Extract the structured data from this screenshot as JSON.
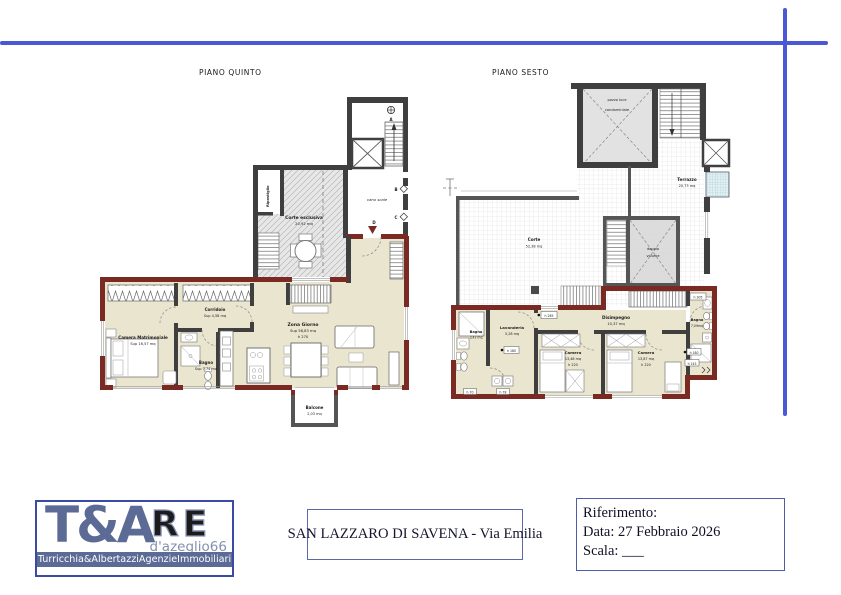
{
  "accent": {
    "line_blue": "#4a58d5",
    "wall_red": "#7a2923",
    "logo_blue": "#5c6a96"
  },
  "plan_quinto": {
    "title": "PIANO QUINTO",
    "vano_scale": "vano scale",
    "ripostiglio": "Ripostiglio",
    "corte_name": "Corte esclusiva",
    "corte_area": "20,92 mq",
    "camera_name": "Camera Matrimoniale",
    "camera_area": "Sup 16,57 mq",
    "corridoio_name": "Corridoio",
    "corridoio_area": "Sup 4,58 mq",
    "bagno_name": "Bagno",
    "bagno_area": "Sup 7,74 mq",
    "zona_name": "Zona Giorno",
    "zona_area": "Sup 58,83 mq",
    "zona_h": "h 270",
    "balcone_name": "Balcone",
    "balcone_area": "2,03 mq",
    "marker_a": "A",
    "marker_b": "B",
    "marker_c": "C",
    "marker_d": "D"
  },
  "plan_sesto": {
    "title": "PIANO SESTO",
    "pozzo_1": "pozzo luce",
    "pozzo_2": "condominiale",
    "terrazzo_name": "Terrazzo",
    "terrazzo_area": "20,73 mq",
    "corte_name": "Corte",
    "corte_area": "52,38 mq",
    "doppio_1": "doppio",
    "doppio_2": "volume",
    "bagno_sx_name": "Bagno",
    "bagno_sx_area": "3,42 mq",
    "lavanderia_name": "Lavanderia",
    "lavanderia_area": "5,28 mq",
    "disimpegno_name": "Disimpegno",
    "disimpegno_area": "10,37 mq",
    "camera1_name": "Camera",
    "camera1_area": "13,48 mq",
    "camera1_h": "h 220",
    "camera2_name": "Camera",
    "camera2_area": "13,87 mq",
    "cam2_h": "h 220",
    "bagno_dx_name": "Bagno",
    "bagno_dx_area": "7,09mq",
    "h305": "h 305",
    "h265": "h 265",
    "h180_a": "h 180",
    "h180_b": "h 180",
    "h143": "h 143",
    "h70": "h 70",
    "h78": "h 78"
  },
  "footer": {
    "logo_ta": "T&A",
    "logo_re": "RE",
    "logo_sub": "d'azeglio66",
    "logo_agency": "Turricchia&AlbertazziAgenzieImmobiliari",
    "property_title": "SAN LAZZARO DI SAVENA - Via Emilia",
    "ref_label": "Riferimento:",
    "ref_date": "Data: 27 Febbraio 2026",
    "ref_scale": "Scala: ___"
  }
}
